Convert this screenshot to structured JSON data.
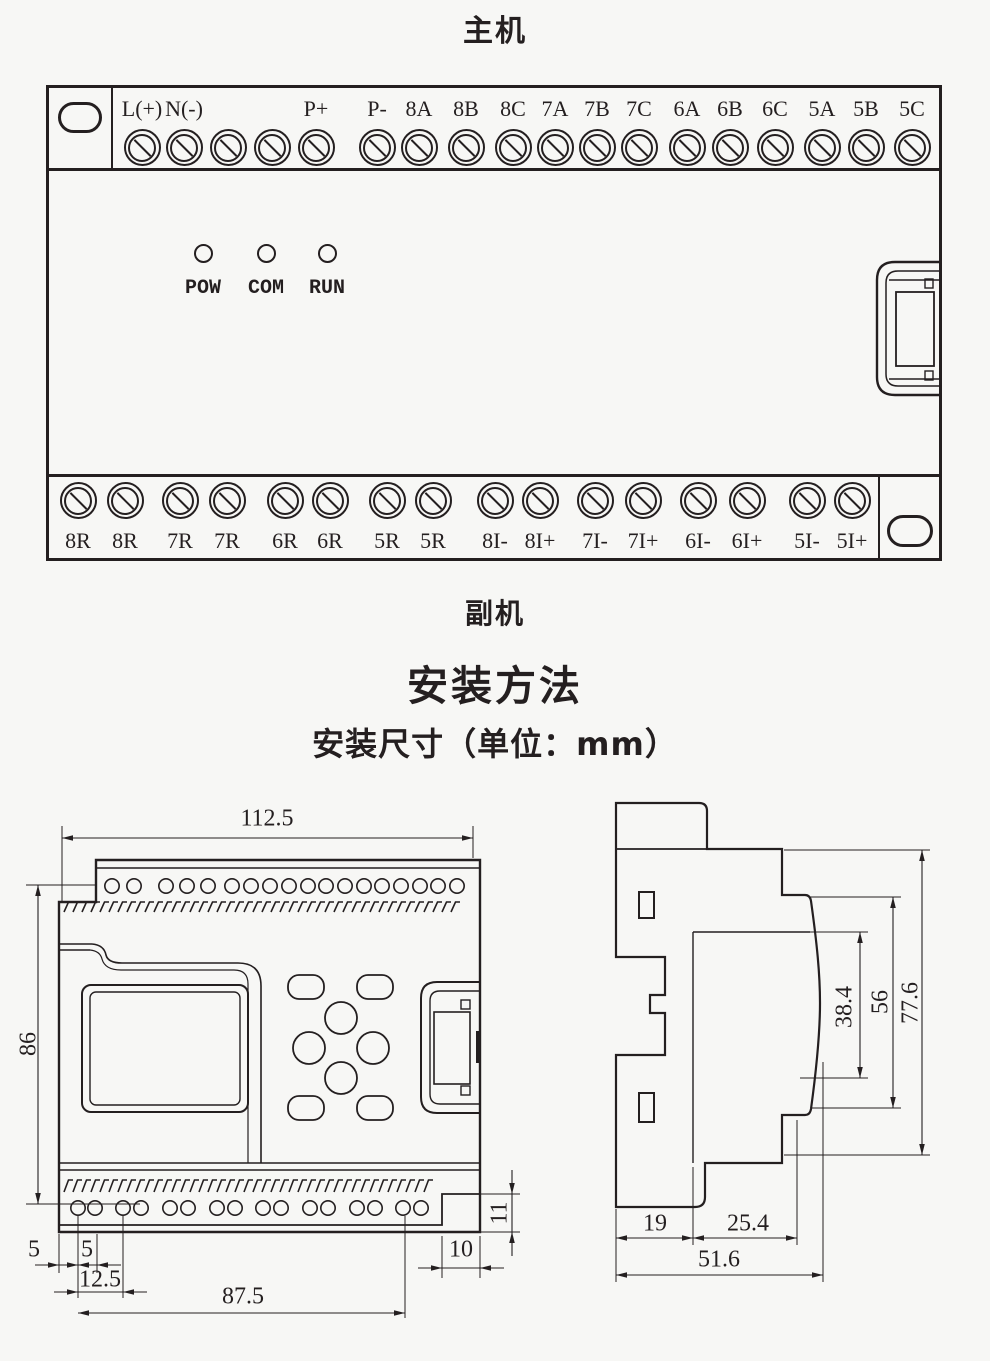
{
  "page": {
    "background": "#f7f7f5",
    "line_color": "#241f20"
  },
  "main_unit": {
    "title": "主机",
    "top_terminals": [
      "L(+)",
      "N(-)",
      "",
      "",
      "P+",
      "P-",
      "8A",
      "8B",
      "8C",
      "7A",
      "7B",
      "7C",
      "6A",
      "6B",
      "6C",
      "5A",
      "5B",
      "5C"
    ],
    "leds": [
      "POW",
      "COM",
      "RUN"
    ],
    "bottom_terminals": [
      "8R",
      "8R",
      "7R",
      "7R",
      "6R",
      "6R",
      "5R",
      "5R",
      "8I-",
      "8I+",
      "7I-",
      "7I+",
      "6I-",
      "6I+",
      "5I-",
      "5I+"
    ],
    "footer_label": "副机"
  },
  "installation": {
    "heading": "安装方法",
    "subheading": "安装尺寸（单位：mm）",
    "front_view": {
      "width": "112.5",
      "height": "86",
      "edge_offset": "5",
      "hole_gap": "5",
      "hole_pitch": "12.5",
      "hole_span": "87.5",
      "notch_width": "10",
      "notch_height": "11"
    },
    "side_view": {
      "clip_depth": "19",
      "front_depth": "25.4",
      "total_depth": "51.6",
      "panel_height": "38.4",
      "body_height": "56",
      "total_height": "77.6"
    }
  }
}
